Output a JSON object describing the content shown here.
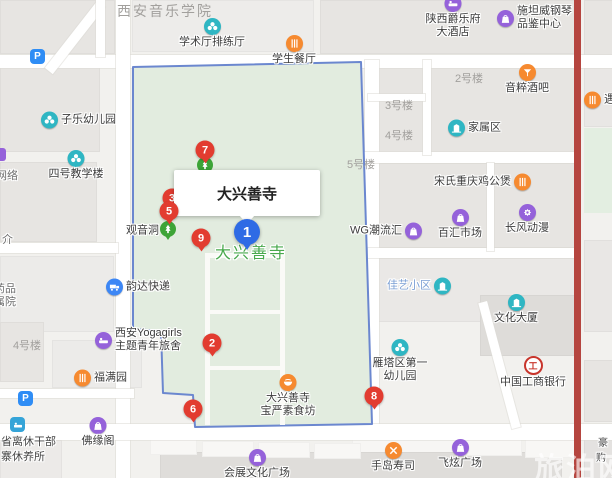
{
  "info_window": {
    "title": "大兴善寺"
  },
  "map_label": "大兴善寺",
  "watermark": "旅泊网",
  "parking_label": "P",
  "bank_glyph": "工",
  "markers": {
    "m1": "1",
    "m2": "2",
    "m3": "3",
    "m5": "5",
    "m6": "6",
    "m7": "7",
    "m8": "8",
    "m9": "9"
  },
  "pois": {
    "yinyue_xueyuan": "西安音乐学院",
    "xueshuting": "学术厅排练厅",
    "xuesheng_canting": "学生餐厅",
    "zile_youeryuan": "子乐幼儿园",
    "sihao_jiaoxuelou": "四号教学楼",
    "guanyindong": "观音洞",
    "yunda": "韵达快递",
    "juelefu_1": "陕西爵乐府",
    "juelefu_2": "大酒店",
    "shitanwei_1": "施坦威钢琴",
    "shitanwei_2": "品鉴中心",
    "yincui": "音粹酒吧",
    "jiashuqu": "家属区",
    "songshi": "宋氏重庆鸡公煲",
    "wg": "WG潮流汇",
    "baihui": "百汇市场",
    "changfeng": "长风动漫",
    "jiayi": "佳艺小区",
    "wenhua_dasha": "文化大厦",
    "yata_1": "雁塔区第一",
    "yata_2": "幼儿园",
    "icbc": "中国工商银行",
    "shoudao": "手岛寿司",
    "feixuan": "飞炫广场",
    "yoga_1": "西安Yogagirls",
    "yoga_2": "主题青年旅舍",
    "fumanyuan": "福满园",
    "sushifang_1": "大兴善寺",
    "sushifang_2": "宝严素食坊",
    "foyuange": "佛缘阁",
    "huizhan": "会展文化广场",
    "clipped_right": "遇",
    "louhao": {
      "lou2": "2号楼",
      "lou3": "3号楼",
      "lou4": "4号楼",
      "lou5": "5号楼",
      "lou4b": "4号楼"
    },
    "clipped_left": {
      "wangluo": "网络",
      "jie": "介",
      "yaopin": "药品",
      "shuyuan": "属院"
    },
    "xiuyangsuo_1": "省离休干部",
    "xiuyangsuo_2": "寨休养所",
    "clipped_br_1": "豪",
    "clipped_br_2": "购"
  },
  "colors": {
    "selected_marker": "#2e6be5",
    "numbered_marker": "#e23c30",
    "boundary": "#6b87cf",
    "temple_fill": "#e2ecdf",
    "highlight_road": "#b5453f"
  }
}
